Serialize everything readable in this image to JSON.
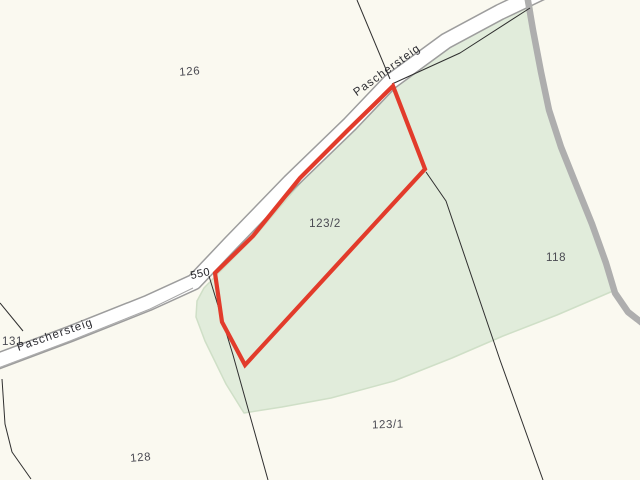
{
  "map": {
    "kind": "cadastral-parcel-map",
    "background": "#faf9f0",
    "colors": {
      "land_green": "#e1ecdb",
      "land_green_edge": "#cfdfc7",
      "road_fill": "#ffffff",
      "road_casing": "#9d9d9d",
      "track_gray": "#aeaeae",
      "boundary_line": "#2f2f2f",
      "highlight_red": "#e23b2b",
      "parcel_label_color": "#4a4a52",
      "road_label_color": "#2e2e33"
    },
    "road_name": "Paschersteig",
    "highlighted_parcel": "123/2",
    "parcels": {
      "p126": "126",
      "p131": "131",
      "p128": "128",
      "p118": "118",
      "p123_1": "123/1",
      "p123_2": "123/2",
      "p550": "550"
    }
  }
}
